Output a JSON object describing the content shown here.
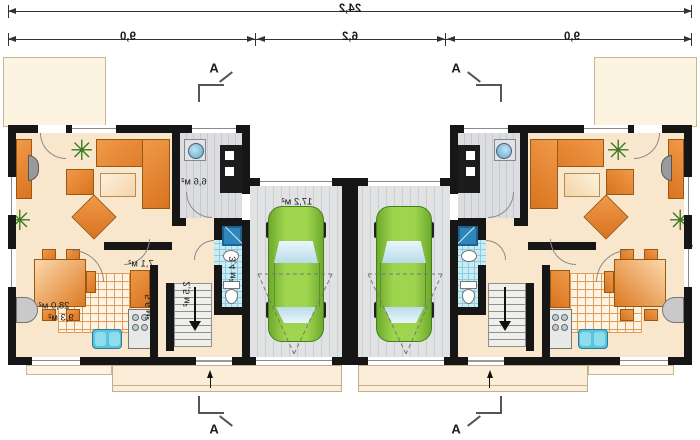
{
  "drawing": {
    "section_marker": "A",
    "dimensions": {
      "total_width": "24,2",
      "left_segment": "9,0",
      "middle_segment": "6,2",
      "right_segment": "9,0",
      "depth": "8,9"
    },
    "rooms": {
      "living": "28,0 м²",
      "vestibule": "6,6 м²",
      "hall": "7,1 м²",
      "kitchen": "9,3 м²",
      "corridor": "5,6 м²",
      "stairs": "2,5 м²",
      "bathroom": "3,4 м²",
      "garage": "17,2 м²"
    },
    "icons": {
      "plant": "✳"
    },
    "colors": {
      "floor": "#f9e7cd",
      "terrace": "#fdf3e1",
      "wall": "#161616",
      "garage_floor": "#dfe1e3",
      "furniture_orange": "#e0812f",
      "car_green": "#8dc63f",
      "bathroom_tile": "#c9ecf4",
      "shower_blue": "#2f86bb",
      "dimension_line": "#333333"
    }
  }
}
